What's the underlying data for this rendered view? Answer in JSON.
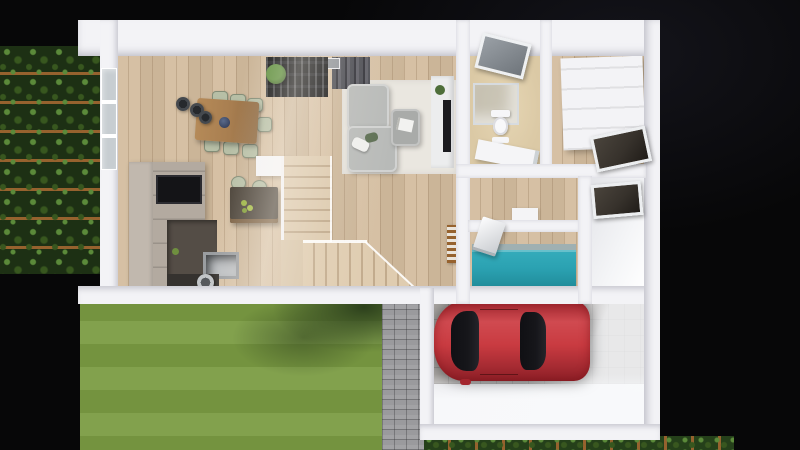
{
  "meta": {
    "title": "3D rendered floor plan — top-down cutaway of a house ground floor with garden, garage and red car",
    "view": "top-down architectural render",
    "visible_text": "none"
  },
  "colors": {
    "bg": "#070708",
    "wall": "#f3f3f6",
    "wall_shade": "#d7d8de",
    "wood": "#d3bc9e",
    "bath_floor": "#dbc9a5",
    "lawn_a": "#74933f",
    "lawn_b": "#82a14d",
    "lawn_shadow": "#2c401c",
    "ivy_dark": "#1d3014",
    "ivy_mid": "#38571f",
    "ivy_light": "#5b8a3a",
    "trellis": "#96622e",
    "hedge": "#25401a",
    "path": "#9a9a9d",
    "concrete": "#a8a5a2",
    "car_red": "#c93b41",
    "car_red_dark": "#8e2028",
    "car_glass": "#16161a",
    "teal": "#2ba2b2",
    "sofa": "#b8bab8",
    "rug": "#eae7e0",
    "cabinet": "#b3aaa0",
    "counter_dark": "#544d46",
    "island_top": "#4a4238",
    "appliance": "#141417",
    "bookshelf": "#191a1d",
    "curtain": "#4a4b52",
    "sage": "#b7bfa6",
    "table_wood": "#a87e50",
    "steel": "#bcbfc2",
    "window_dark": "#37322c",
    "glass": "#c7cdd1"
  },
  "rooms": [
    {
      "name": "living-room"
    },
    {
      "name": "dining-area"
    },
    {
      "name": "kitchen"
    },
    {
      "name": "staircase"
    },
    {
      "name": "bathroom"
    },
    {
      "name": "entry-hall"
    },
    {
      "name": "hallway"
    },
    {
      "name": "study-nook"
    },
    {
      "name": "utility-room"
    },
    {
      "name": "garage"
    },
    {
      "name": "garden-lawn"
    },
    {
      "name": "garden-path"
    },
    {
      "name": "ivy-green-wall"
    },
    {
      "name": "boundary-hedge"
    }
  ],
  "objects": [
    {
      "name": "gray-corner-sofa",
      "room": "living-room"
    },
    {
      "name": "ottoman-coffee-table",
      "room": "living-room"
    },
    {
      "name": "area-rug",
      "room": "living-room"
    },
    {
      "name": "tv-console-and-tv",
      "room": "living-room"
    },
    {
      "name": "dark-curtains",
      "room": "living-room"
    },
    {
      "name": "black-bookshelf-with-plant",
      "room": "living-room"
    },
    {
      "name": "wooden-dining-table",
      "room": "dining-area",
      "count_chairs": 7
    },
    {
      "name": "pendant-lamps",
      "room": "dining-area",
      "count": 3
    },
    {
      "name": "taupe-cabinet-run-with-oven",
      "room": "kitchen"
    },
    {
      "name": "dark-countertop-sink-cooktop",
      "room": "kitchen"
    },
    {
      "name": "kitchen-island-with-stools-and-fruit",
      "room": "kitchen"
    },
    {
      "name": "l-shaped-wooden-stairs-with-glass-rail",
      "room": "staircase"
    },
    {
      "name": "slatted-radiator-bench",
      "room": "living-room"
    },
    {
      "name": "glass-shower",
      "room": "bathroom"
    },
    {
      "name": "toilet",
      "room": "bathroom"
    },
    {
      "name": "bidet",
      "room": "bathroom"
    },
    {
      "name": "white-vanity",
      "room": "bathroom"
    },
    {
      "name": "gray-skylight",
      "room": "bathroom"
    },
    {
      "name": "white-wardrobe",
      "room": "entry-hall"
    },
    {
      "name": "dark-window",
      "room": "entry-hall"
    },
    {
      "name": "dark-window",
      "room": "utility-room"
    },
    {
      "name": "teal-desk-with-laptop",
      "room": "study-nook"
    },
    {
      "name": "red-hatchback-car",
      "room": "garage"
    },
    {
      "name": "striped-mowed-lawn-with-tree-shadow",
      "room": "garden-lawn"
    },
    {
      "name": "gray-paver-path",
      "room": "garden-path"
    }
  ]
}
